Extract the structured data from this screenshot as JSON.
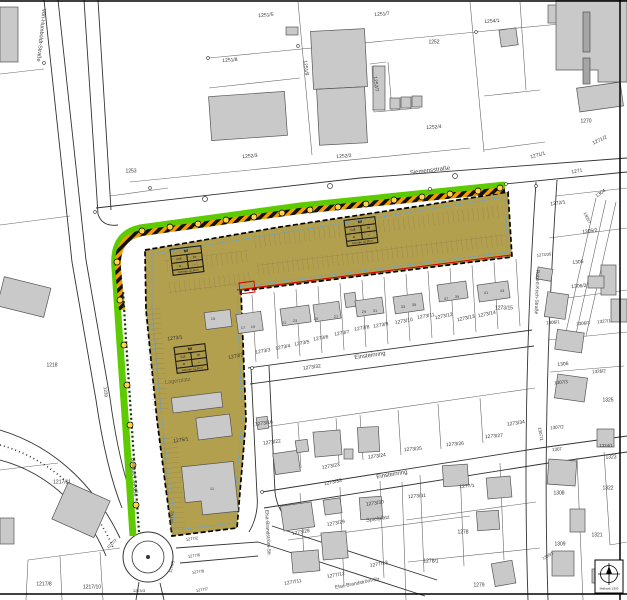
{
  "map_title": "Bebauungsplan-Ausschnitt",
  "colors": {
    "zone_fill": "#b3a04f",
    "green_strip": "#5ecb00",
    "hazard_orange": "#f59d00",
    "boundary_red": "#d40000",
    "boundary_blue": "#58a6e8",
    "building_gray": "#c9c9c9"
  },
  "zoning": {
    "box1": {
      "use": "MI",
      "grz": "0,8",
      "floors": "IV",
      "bauweise": "a",
      "mark": "–",
      "height": "GH max. 15,50 m"
    },
    "box2": {
      "use": "MI",
      "grz": "0,8",
      "floors": "III",
      "bauweise": "a",
      "mark": "–",
      "height": "GH max. 12,50 m"
    },
    "box3": {
      "use": "MI",
      "grz": "0,8",
      "floors": "IV",
      "bauweise": "a",
      "mark": "–",
      "height": "GH max. 15,50 m"
    }
  },
  "legend": {
    "scale_text": "Maßstab 1:500"
  },
  "map_labels": [
    {
      "t": "Von-Humboldt-Straße",
      "x": 40,
      "y": 35,
      "r": 96,
      "s": 5.5,
      "c": "#444",
      "n": "street-label-von-humboldt"
    },
    {
      "t": "Siemensstraße",
      "x": 430,
      "y": 171,
      "r": -7,
      "s": 6,
      "c": "#444",
      "n": "street-label-siemensstrasse"
    },
    {
      "t": "Unnauer Straße",
      "x": 133,
      "y": 477,
      "r": 86,
      "s": 5.5,
      "c": "#444",
      "n": "street-label-unnauer"
    },
    {
      "t": "Einsteinring",
      "x": 370,
      "y": 356,
      "r": -8,
      "s": 6,
      "c": "#444",
      "n": "street-label-einsteinring-1"
    },
    {
      "t": "Einsteinring",
      "x": 392,
      "y": 475,
      "r": -9,
      "s": 6,
      "c": "#444",
      "n": "street-label-einsteinring-2"
    },
    {
      "t": "Elsa-Brandström-Str.",
      "x": 267,
      "y": 533,
      "r": 87,
      "s": 5,
      "c": "#444",
      "n": "street-label-elsa-1"
    },
    {
      "t": "Elsa-Brandström-Str.",
      "x": 358,
      "y": 584,
      "r": -11,
      "s": 5,
      "c": "#444",
      "n": "street-label-elsa-2"
    },
    {
      "t": "Robert-Koch-Straße",
      "x": 536,
      "y": 292,
      "r": 92,
      "s": 5,
      "c": "#444",
      "n": "street-label-robert-koch"
    },
    {
      "t": "Spielplatz",
      "x": 378,
      "y": 520,
      "r": -8,
      "s": 5.5,
      "c": "#555",
      "n": "area-label-spielplatz"
    },
    {
      "t": "Lagerplatz",
      "x": 178,
      "y": 382,
      "r": -7,
      "s": 5.5,
      "c": "#6b6039",
      "n": "area-label-lagerplatz"
    },
    {
      "t": "1239",
      "x": 105,
      "y": 392,
      "r": 83,
      "s": 4.5
    },
    {
      "t": "1251/5",
      "x": 266,
      "y": 16,
      "r": -5
    },
    {
      "t": "1251/7",
      "x": 382,
      "y": 15,
      "r": -5
    },
    {
      "t": "1254/1",
      "x": 492,
      "y": 22,
      "r": -4
    },
    {
      "t": "1252",
      "x": 434,
      "y": 43
    },
    {
      "t": "1251/8",
      "x": 230,
      "y": 61,
      "r": -5
    },
    {
      "t": "1251/9",
      "x": 305,
      "y": 68,
      "r": 83
    },
    {
      "t": "1252/7",
      "x": 375,
      "y": 84,
      "r": 83
    },
    {
      "t": "1253",
      "x": 131,
      "y": 172
    },
    {
      "t": "1252/3",
      "x": 250,
      "y": 157,
      "r": -5
    },
    {
      "t": "1252/2",
      "x": 344,
      "y": 157,
      "r": -5
    },
    {
      "t": "1252/4",
      "x": 434,
      "y": 128,
      "r": -4
    },
    {
      "t": "1270",
      "x": 586,
      "y": 122
    },
    {
      "t": "1271/2",
      "x": 600,
      "y": 141,
      "r": -25
    },
    {
      "t": "1271/1",
      "x": 538,
      "y": 156,
      "r": -15
    },
    {
      "t": "1271",
      "x": 577,
      "y": 172,
      "r": -10
    },
    {
      "t": "1304",
      "x": 601,
      "y": 194,
      "r": -35
    },
    {
      "t": "1218",
      "x": 52,
      "y": 366
    },
    {
      "t": "1217/11",
      "x": 62,
      "y": 483
    },
    {
      "t": "1217/8",
      "x": 44,
      "y": 585
    },
    {
      "t": "1217/10",
      "x": 92,
      "y": 588
    },
    {
      "t": "1217/7",
      "x": 112,
      "y": 544,
      "r": -45,
      "s": 4
    },
    {
      "t": "1274/5",
      "x": 172,
      "y": 567,
      "r": -75,
      "s": 4
    },
    {
      "t": "1274/3",
      "x": 139,
      "y": 591,
      "s": 4
    },
    {
      "t": "1275/1",
      "x": 181,
      "y": 441,
      "r": -8
    },
    {
      "t": "1275/1",
      "x": 172,
      "y": 517,
      "r": -85,
      "s": 4
    },
    {
      "t": "1273/1",
      "x": 175,
      "y": 339,
      "r": -7
    },
    {
      "t": "1273/2",
      "x": 236,
      "y": 357,
      "r": -12
    },
    {
      "t": "1273/3",
      "x": 263,
      "y": 352,
      "r": -10
    },
    {
      "t": "1273/4",
      "x": 283,
      "y": 348,
      "r": -10
    },
    {
      "t": "1273/5",
      "x": 302,
      "y": 344,
      "r": -10
    },
    {
      "t": "1273/6",
      "x": 321,
      "y": 339,
      "r": -10
    },
    {
      "t": "1273/7",
      "x": 342,
      "y": 334,
      "r": -10
    },
    {
      "t": "1273/8",
      "x": 362,
      "y": 329,
      "r": -10
    },
    {
      "t": "1273/9",
      "x": 381,
      "y": 326,
      "r": -10
    },
    {
      "t": "1273/10",
      "x": 404,
      "y": 322,
      "r": -10
    },
    {
      "t": "1273/11",
      "x": 426,
      "y": 317,
      "r": -10
    },
    {
      "t": "1273/12",
      "x": 444,
      "y": 317,
      "r": -12
    },
    {
      "t": "1273/13",
      "x": 466,
      "y": 319,
      "r": -12
    },
    {
      "t": "1273/14",
      "x": 487,
      "y": 315,
      "r": -12
    },
    {
      "t": "1273/15",
      "x": 504,
      "y": 309
    },
    {
      "t": "1273/32",
      "x": 312,
      "y": 368,
      "r": -8
    },
    {
      "t": "1273/16",
      "x": 264,
      "y": 424,
      "r": -8
    },
    {
      "t": "1273/22",
      "x": 272,
      "y": 443,
      "r": -8
    },
    {
      "t": "1273/23",
      "x": 331,
      "y": 467,
      "r": -10
    },
    {
      "t": "1273/24",
      "x": 377,
      "y": 457,
      "r": -8
    },
    {
      "t": "1273/33",
      "x": 333,
      "y": 483,
      "r": -12
    },
    {
      "t": "1273/30",
      "x": 375,
      "y": 504,
      "r": -8
    },
    {
      "t": "1273/28",
      "x": 301,
      "y": 533,
      "r": -10
    },
    {
      "t": "1273/29",
      "x": 336,
      "y": 524,
      "r": -10
    },
    {
      "t": "1277/11",
      "x": 293,
      "y": 583,
      "r": -10
    },
    {
      "t": "1277/12",
      "x": 336,
      "y": 576,
      "r": -10
    },
    {
      "t": "1277/13",
      "x": 379,
      "y": 565,
      "r": -10
    },
    {
      "t": "1277/2",
      "x": 192,
      "y": 539,
      "r": -8,
      "s": 4
    },
    {
      "t": "1277/6",
      "x": 194,
      "y": 556,
      "r": -8,
      "s": 4
    },
    {
      "t": "1277/8",
      "x": 198,
      "y": 572,
      "r": -8,
      "s": 4
    },
    {
      "t": "1277/7",
      "x": 202,
      "y": 590,
      "r": -8,
      "s": 4
    },
    {
      "t": "1273/25",
      "x": 413,
      "y": 450,
      "r": -5
    },
    {
      "t": "1273/26",
      "x": 455,
      "y": 445,
      "r": -5
    },
    {
      "t": "1273/27",
      "x": 494,
      "y": 437,
      "r": -5
    },
    {
      "t": "1273/34",
      "x": 516,
      "y": 424,
      "r": -8
    },
    {
      "t": "1307/2",
      "x": 557,
      "y": 428,
      "r": -5,
      "s": 4.5
    },
    {
      "t": "1307/1",
      "x": 540,
      "y": 434,
      "r": 80,
      "s": 4.5
    },
    {
      "t": "1307",
      "x": 557,
      "y": 450,
      "r": -5,
      "s": 4.5
    },
    {
      "t": "1324/1",
      "x": 606,
      "y": 446,
      "s": 4.5
    },
    {
      "t": "1323",
      "x": 611,
      "y": 458
    },
    {
      "t": "1322",
      "x": 608,
      "y": 489
    },
    {
      "t": "1321",
      "x": 597,
      "y": 536
    },
    {
      "t": "1308",
      "x": 559,
      "y": 494
    },
    {
      "t": "1309",
      "x": 560,
      "y": 545
    },
    {
      "t": "1309/1",
      "x": 548,
      "y": 556,
      "r": -30,
      "s": 4
    },
    {
      "t": "1277/1",
      "x": 467,
      "y": 487,
      "r": -5
    },
    {
      "t": "1273/31",
      "x": 417,
      "y": 497,
      "r": -5
    },
    {
      "t": "1278",
      "x": 463,
      "y": 533
    },
    {
      "t": "1278/1",
      "x": 431,
      "y": 562
    },
    {
      "t": "1279",
      "x": 479,
      "y": 586
    },
    {
      "t": "1325",
      "x": 608,
      "y": 401
    },
    {
      "t": "1272/1",
      "x": 558,
      "y": 204,
      "r": -8
    },
    {
      "t": "1305/2",
      "x": 590,
      "y": 232,
      "r": -8
    },
    {
      "t": "1305",
      "x": 578,
      "y": 263,
      "r": -5
    },
    {
      "t": "1273/35",
      "x": 544,
      "y": 255,
      "r": -5,
      "s": 4
    },
    {
      "t": "1305/7",
      "x": 587,
      "y": 218,
      "r": 65,
      "s": 4
    },
    {
      "t": "1306/2",
      "x": 579,
      "y": 287,
      "r": -5
    },
    {
      "t": "1306/1",
      "x": 553,
      "y": 323,
      "r": -5,
      "s": 4.5
    },
    {
      "t": "1306/3",
      "x": 583,
      "y": 324,
      "r": -5,
      "s": 4.5
    },
    {
      "t": "1327/1",
      "x": 604,
      "y": 322,
      "r": -5,
      "s": 4.5
    },
    {
      "t": "1306",
      "x": 563,
      "y": 365,
      "r": -5
    },
    {
      "t": "1326/2",
      "x": 599,
      "y": 372,
      "r": -5,
      "s": 4.5
    },
    {
      "t": "1307/3",
      "x": 561,
      "y": 383,
      "r": -5,
      "s": 4.5
    },
    {
      "t": "15",
      "x": 213,
      "y": 319,
      "s": 4,
      "c": "#444"
    },
    {
      "t": "17",
      "x": 243,
      "y": 328,
      "s": 4,
      "c": "#444"
    },
    {
      "t": "19",
      "x": 253,
      "y": 327,
      "s": 4,
      "c": "#444"
    },
    {
      "t": "21",
      "x": 284,
      "y": 323,
      "s": 4,
      "c": "#444"
    },
    {
      "t": "23",
      "x": 295,
      "y": 321,
      "s": 4,
      "c": "#444"
    },
    {
      "t": "25",
      "x": 316,
      "y": 319,
      "s": 4,
      "c": "#444"
    },
    {
      "t": "27",
      "x": 336,
      "y": 317,
      "s": 4,
      "c": "#444"
    },
    {
      "t": "29",
      "x": 364,
      "y": 312,
      "s": 4,
      "c": "#444"
    },
    {
      "t": "31",
      "x": 375,
      "y": 311,
      "s": 4,
      "c": "#444"
    },
    {
      "t": "33",
      "x": 403,
      "y": 307,
      "s": 4,
      "c": "#444"
    },
    {
      "t": "35",
      "x": 414,
      "y": 305,
      "s": 4,
      "c": "#444"
    },
    {
      "t": "37",
      "x": 446,
      "y": 299,
      "s": 4,
      "c": "#444"
    },
    {
      "t": "39",
      "x": 457,
      "y": 297,
      "s": 4,
      "c": "#444"
    },
    {
      "t": "41",
      "x": 486,
      "y": 293,
      "s": 4,
      "c": "#444"
    },
    {
      "t": "43",
      "x": 502,
      "y": 291,
      "s": 4,
      "c": "#444"
    },
    {
      "t": "11",
      "x": 212,
      "y": 489,
      "s": 4,
      "c": "#444"
    },
    {
      "t": "Maßstab 1:500",
      "x": 609,
      "y": 589,
      "s": 2.8,
      "c": "#222",
      "n": "scale-label"
    }
  ]
}
